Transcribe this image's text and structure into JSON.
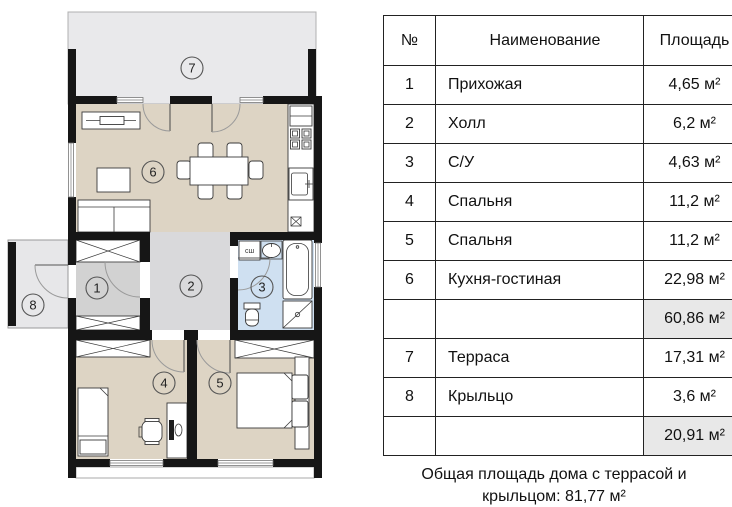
{
  "plan": {
    "room_labels": {
      "r1": "1",
      "r2": "2",
      "r3": "3",
      "r4": "4",
      "r5": "5",
      "r6": "6",
      "r7": "7",
      "r8": "8"
    },
    "washer_label": "сш",
    "colors": {
      "floor_beige": "#ddd4c4",
      "hall_gray": "#d9d9db",
      "entry_gray": "#d2d2d2",
      "bath_blue": "#cfe0f1",
      "terrace_gray": "#e9e9eb",
      "porch_gray": "#e7e7e9",
      "wall_black": "#161616"
    }
  },
  "table": {
    "headers": {
      "num": "№",
      "name": "Наименование",
      "area": "Площадь"
    },
    "rows": [
      {
        "num": "1",
        "name": "Прихожая",
        "area": "4,65 м²",
        "subtotal": false
      },
      {
        "num": "2",
        "name": "Холл",
        "area": "6,2 м²",
        "subtotal": false
      },
      {
        "num": "3",
        "name": "С/У",
        "area": "4,63 м²",
        "subtotal": false
      },
      {
        "num": "4",
        "name": "Спальня",
        "area": "11,2 м²",
        "subtotal": false
      },
      {
        "num": "5",
        "name": "Спальня",
        "area": "11,2 м²",
        "subtotal": false
      },
      {
        "num": "6",
        "name": "Кухня-гостиная",
        "area": "22,98 м²",
        "subtotal": false
      },
      {
        "num": "",
        "name": "",
        "area": "60,86 м²",
        "subtotal": true
      },
      {
        "num": "7",
        "name": "Терраса",
        "area": "17,31 м²",
        "subtotal": false
      },
      {
        "num": "8",
        "name": "Крыльцо",
        "area": "3,6 м²",
        "subtotal": false
      },
      {
        "num": "",
        "name": "",
        "area": "20,91 м²",
        "subtotal": true
      }
    ],
    "caption_line1": "Общая площадь дома с террасой и",
    "caption_line2": "крыльцом: 81,77 м²"
  }
}
